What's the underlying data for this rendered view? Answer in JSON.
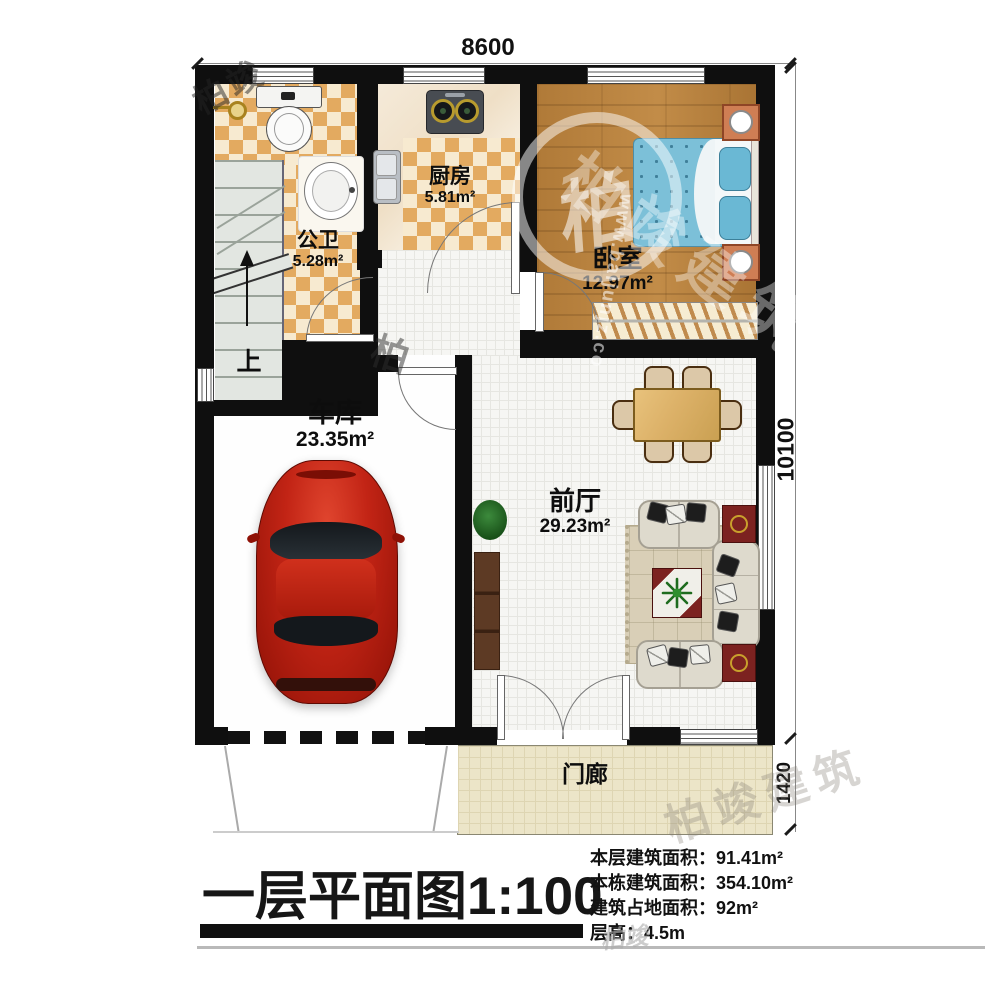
{
  "drawing": {
    "dim_top": "8600",
    "dim_right": "10100",
    "dim_porch": "1420",
    "stairs_up": "上",
    "rooms": {
      "bathroom": {
        "name": "公卫",
        "area": "5.28m²"
      },
      "kitchen": {
        "name": "厨房",
        "area": "5.81m²"
      },
      "bedroom": {
        "name": "卧室",
        "area": "12.97m²"
      },
      "garage": {
        "name": "车库",
        "area": "23.35m²"
      },
      "hall": {
        "name": "前厅",
        "area": "29.23m²"
      },
      "porch": {
        "name": "门廊"
      }
    }
  },
  "titleblock": {
    "title": "一层平面图1:100",
    "stats": [
      {
        "label": "本层建筑面积：",
        "value": "91.41m²"
      },
      {
        "label": "本栋建筑面积：",
        "value": "354.10m²"
      },
      {
        "label": "建筑占地面积：",
        "value": "92m²"
      },
      {
        "label": "层高：",
        "value": "4.5m"
      }
    ]
  },
  "watermark": {
    "brand": "柏竣建筑",
    "brand_short": "柏竣",
    "logo_glyph": "柏",
    "url": "www.baijunjz.co"
  },
  "colors": {
    "wall": "#0f0f0f",
    "tile_dark": "#e3aa60",
    "tile_light": "#f7ead0",
    "wood": "#b6813e",
    "bed_blue": "#7cc0d8",
    "car_red": "#c02415",
    "mahogany": "#7c2220"
  }
}
